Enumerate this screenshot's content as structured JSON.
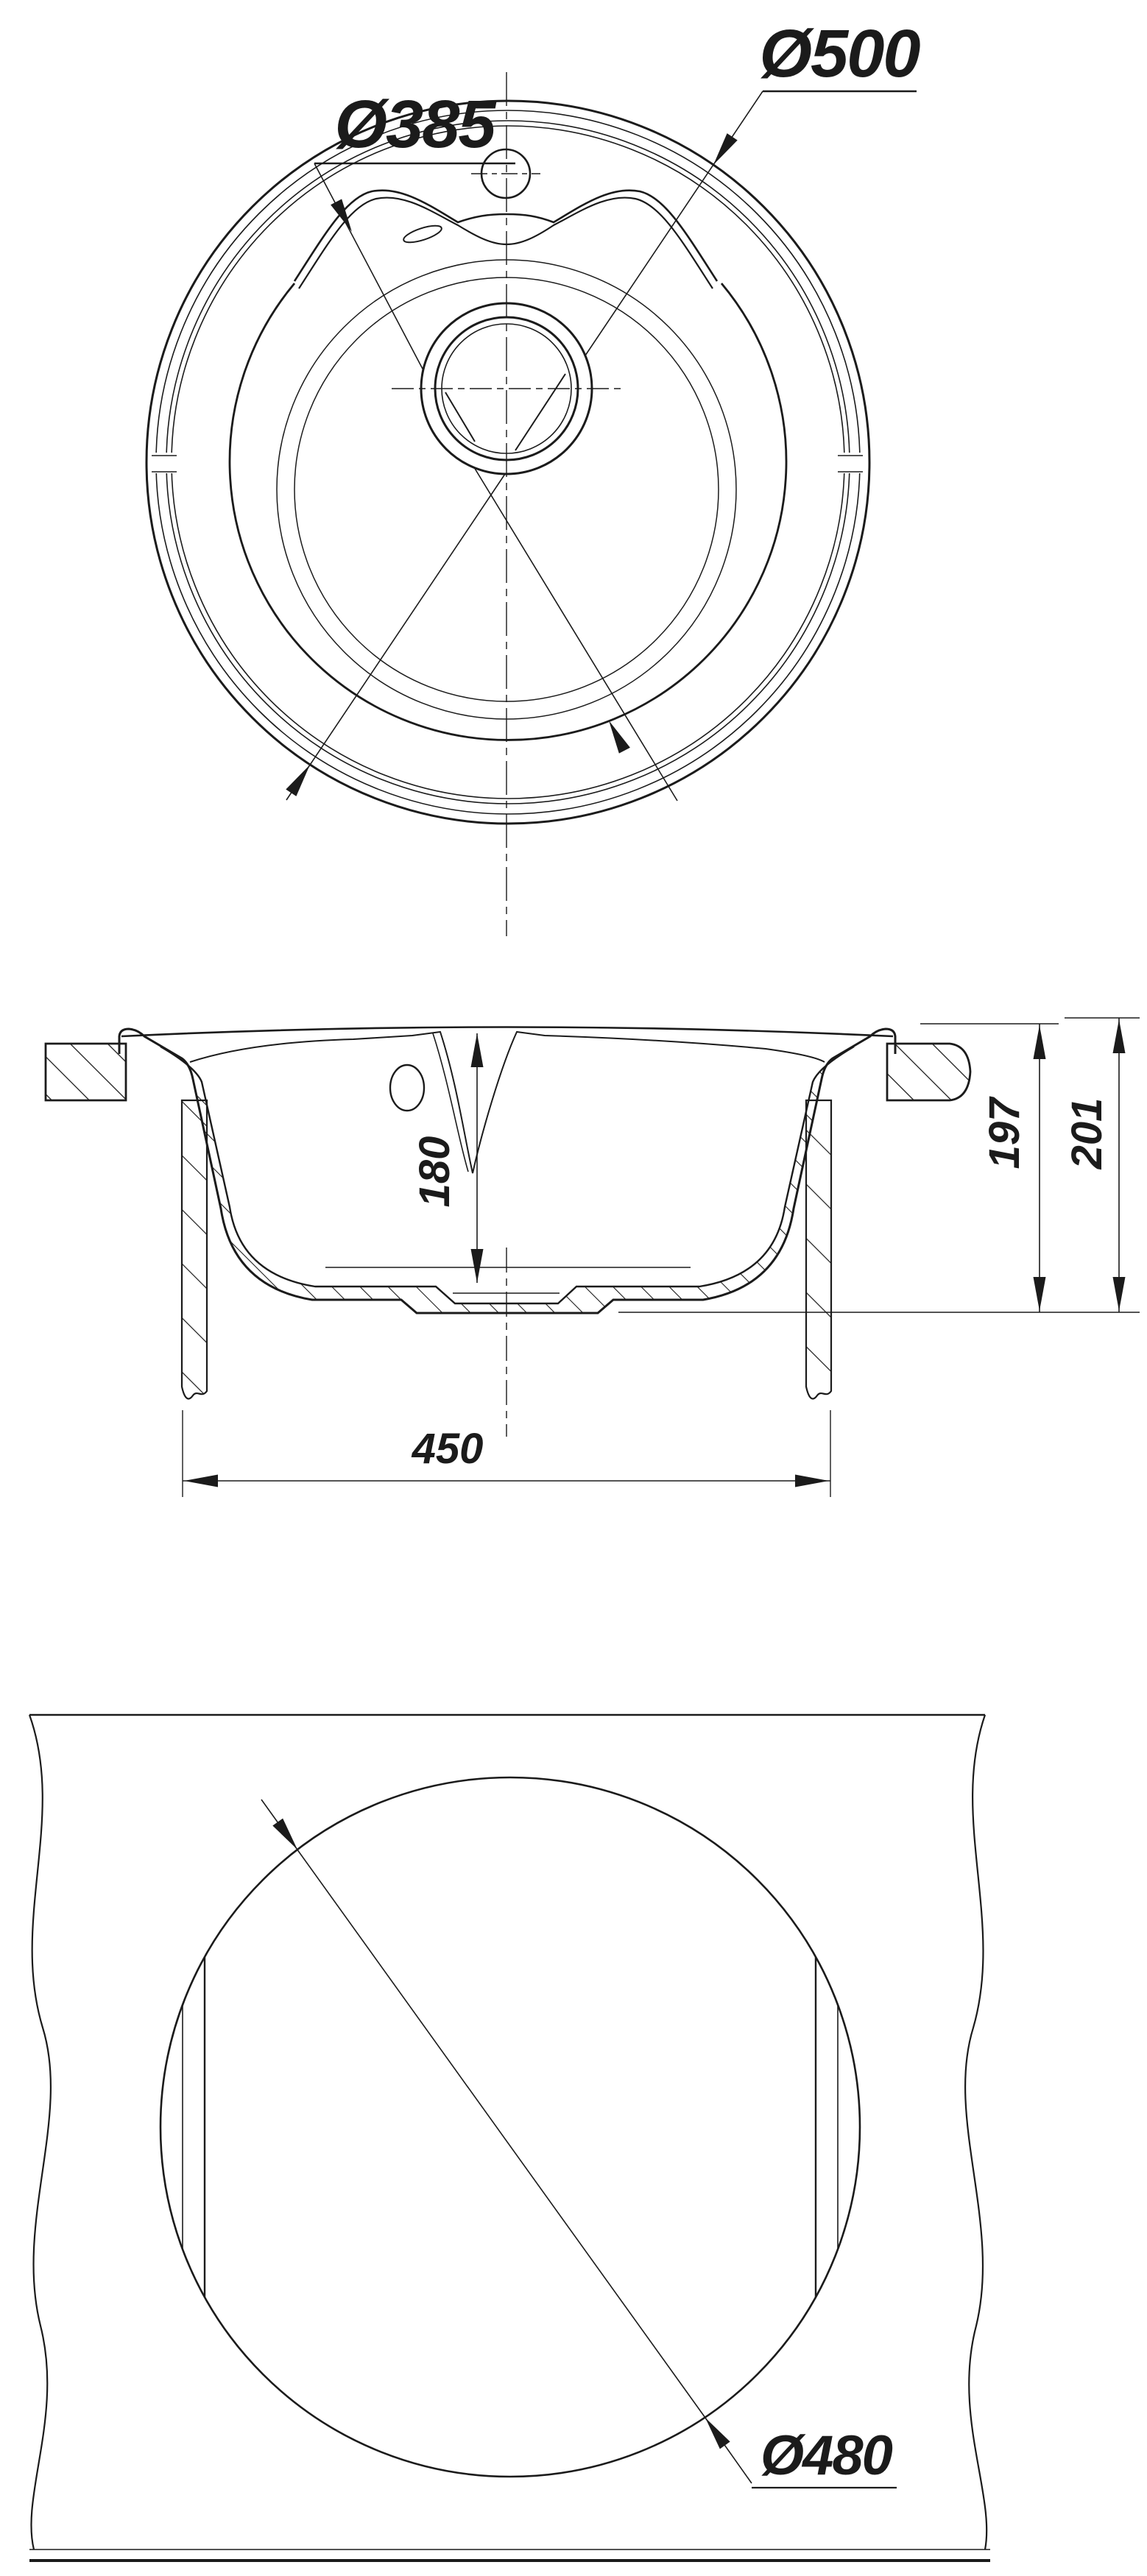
{
  "drawing": {
    "type": "technical-drawing",
    "subject": "round kitchen sink, three orthographic views with dimensions",
    "units": "mm",
    "line_color": "#1b1b1b",
    "background": "#ffffff",
    "top_view": {
      "bowl_diameter_label": "Ø385",
      "outer_diameter_label": "Ø500"
    },
    "section_view": {
      "bowl_depth_label": "180",
      "height_label_1": "197",
      "height_label_2": "201",
      "base_width_label": "450"
    },
    "cutout_view": {
      "cutout_diameter_label": "Ø480"
    }
  }
}
